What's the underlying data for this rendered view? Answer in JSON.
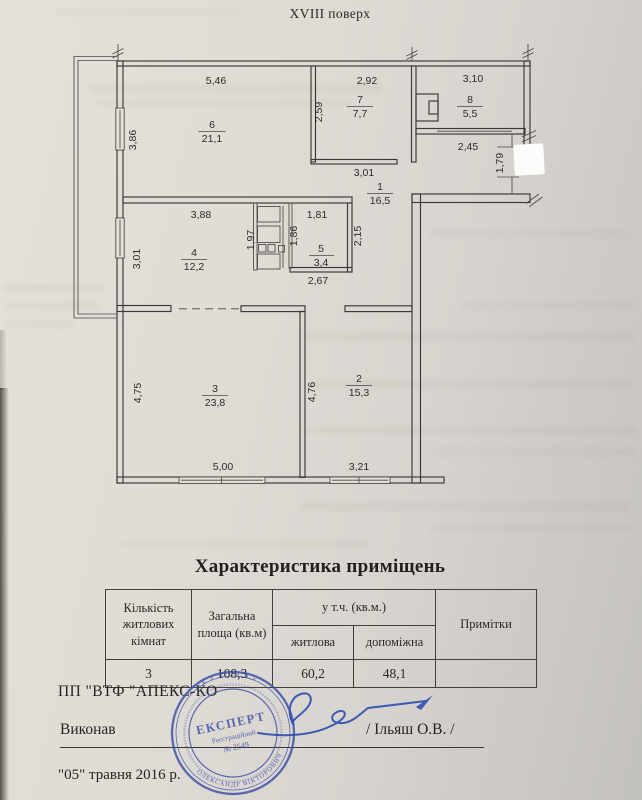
{
  "page": {
    "floor_title": "XVIII поверх",
    "table_title": "Характеристика приміщень"
  },
  "plan": {
    "rooms": {
      "r1": {
        "num": "1",
        "area": "16,5"
      },
      "r2": {
        "num": "2",
        "area": "15,3"
      },
      "r3": {
        "num": "3",
        "area": "23,8"
      },
      "r4": {
        "num": "4",
        "area": "12,2"
      },
      "r5": {
        "num": "5",
        "area": "3,4"
      },
      "r6": {
        "num": "6",
        "area": "21,1"
      },
      "r7": {
        "num": "7",
        "area": "7,7"
      },
      "r8": {
        "num": "8",
        "area": "5,5"
      }
    },
    "dims": {
      "room6_top": "5,46",
      "room7_top": "2,92",
      "room8_top": "3,10",
      "room7_left": "2,59",
      "room6_left": "3,86",
      "room7_bottom": "3,01",
      "room8_bottom": "2,45",
      "entry_door": "1,79",
      "room4_top": "3,88",
      "room5_top": "1,81",
      "closet_left": "1,97",
      "room5_left": "1,86",
      "hall_right": "2,15",
      "room5_bottom": "2,67",
      "room4_left": "3,01",
      "room3_left": "4,75",
      "room2_left": "4,76",
      "room3_bottom": "5,00",
      "room2_bottom": "3,21"
    }
  },
  "table": {
    "col_rooms": "Кількість житлових кімнат",
    "col_total": "Загальна площа (кв.м)",
    "col_incl": "у т.ч. (кв.м.)",
    "col_living": "житлова",
    "col_aux": "допоміжна",
    "col_notes": "Примітки",
    "row": {
      "rooms": "3",
      "total": "108,3",
      "living": "60,2",
      "aux": "48,1",
      "notes": ""
    }
  },
  "footer": {
    "company": "ПП \"ВТФ \"АПЕКС-КО",
    "performed": "Виконав",
    "executor": "/ Ільяш О.В. /",
    "date": "\"05\" травня 2016 р."
  },
  "stamp": {
    "center": "ЕКСПЕРТ",
    "sub1": "Реєстраційний",
    "sub2": "№ 2549",
    "arc_top": "• У К Р А Ї Н А •",
    "arc_bottom": "ОЛЕКСАНДР ВІКТОРОВИЧ",
    "color": "#3c4ea6"
  }
}
